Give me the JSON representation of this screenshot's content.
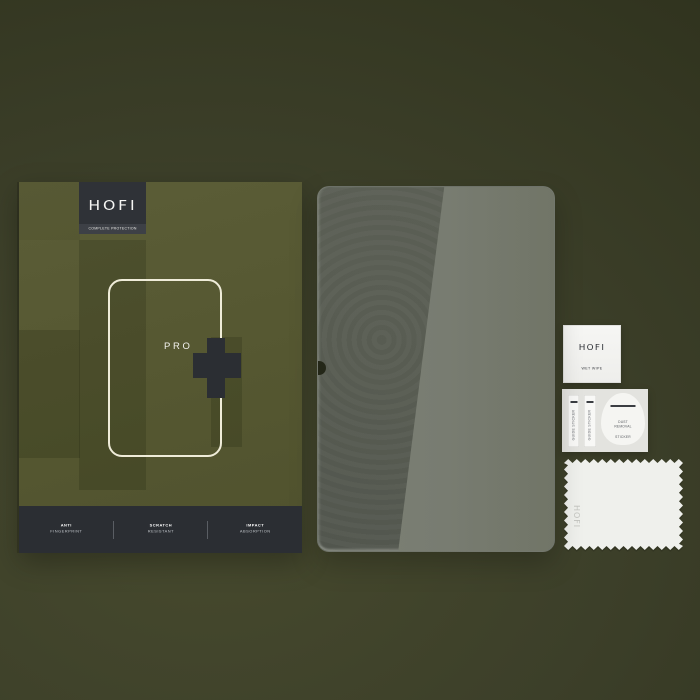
{
  "brand": {
    "name": "HOFI",
    "tagline": "COMPLETE PROTECTION"
  },
  "box": {
    "product_line": "PRO",
    "features": [
      {
        "title": "ANTI",
        "subtitle": "FINGERPRINT"
      },
      {
        "title": "SCRATCH",
        "subtitle": "RESISTANT"
      },
      {
        "title": "IMPACT",
        "subtitle": "ABSORPTION"
      }
    ]
  },
  "accessories": {
    "wet_wipe": {
      "brand": "HOFI",
      "label": "WET WIPE"
    },
    "guide_sticker_label": "GUIDE STICKER",
    "dust_removal_sticker": {
      "line1": "DUST REMOVAL",
      "line2": "STICKER"
    },
    "cloth": {
      "brand": "HOFI"
    }
  },
  "colors": {
    "background_olive": "#3c3f29",
    "box_olive": "#555731",
    "charcoal": "#2b2e33",
    "glass_tint": "#5e6258",
    "accessory_white": "#f2f2ef"
  }
}
